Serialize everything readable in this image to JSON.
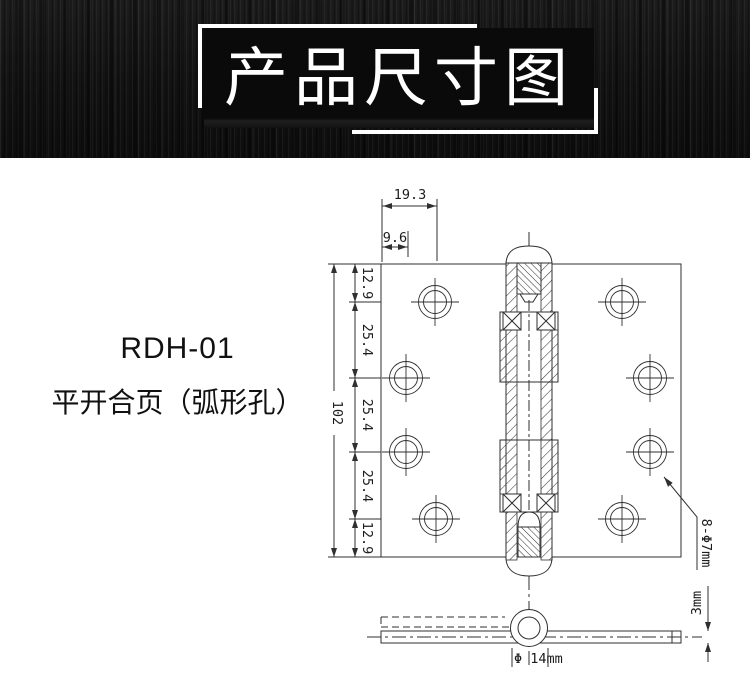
{
  "header": {
    "title": "产品尺寸图"
  },
  "product": {
    "code": "RDH-01",
    "name": "平开合页（弧形孔）"
  },
  "drawing": {
    "dims": {
      "outer_hole_offset": "19.3",
      "inner_hole_offset": "9.6",
      "spacings": [
        "12.9",
        "25.4",
        "25.4",
        "25.4",
        "12.9"
      ],
      "total_length": "102",
      "holes_spec": "8-Φ7mm",
      "leaf_thickness": "3mm",
      "knuckle_diameter": "Φ 14mm"
    }
  },
  "colors": {
    "line": "#2f2f2f",
    "header_bg": "#161616",
    "banner_bg": "#0a0a0a",
    "title_text": "#ffffff"
  }
}
